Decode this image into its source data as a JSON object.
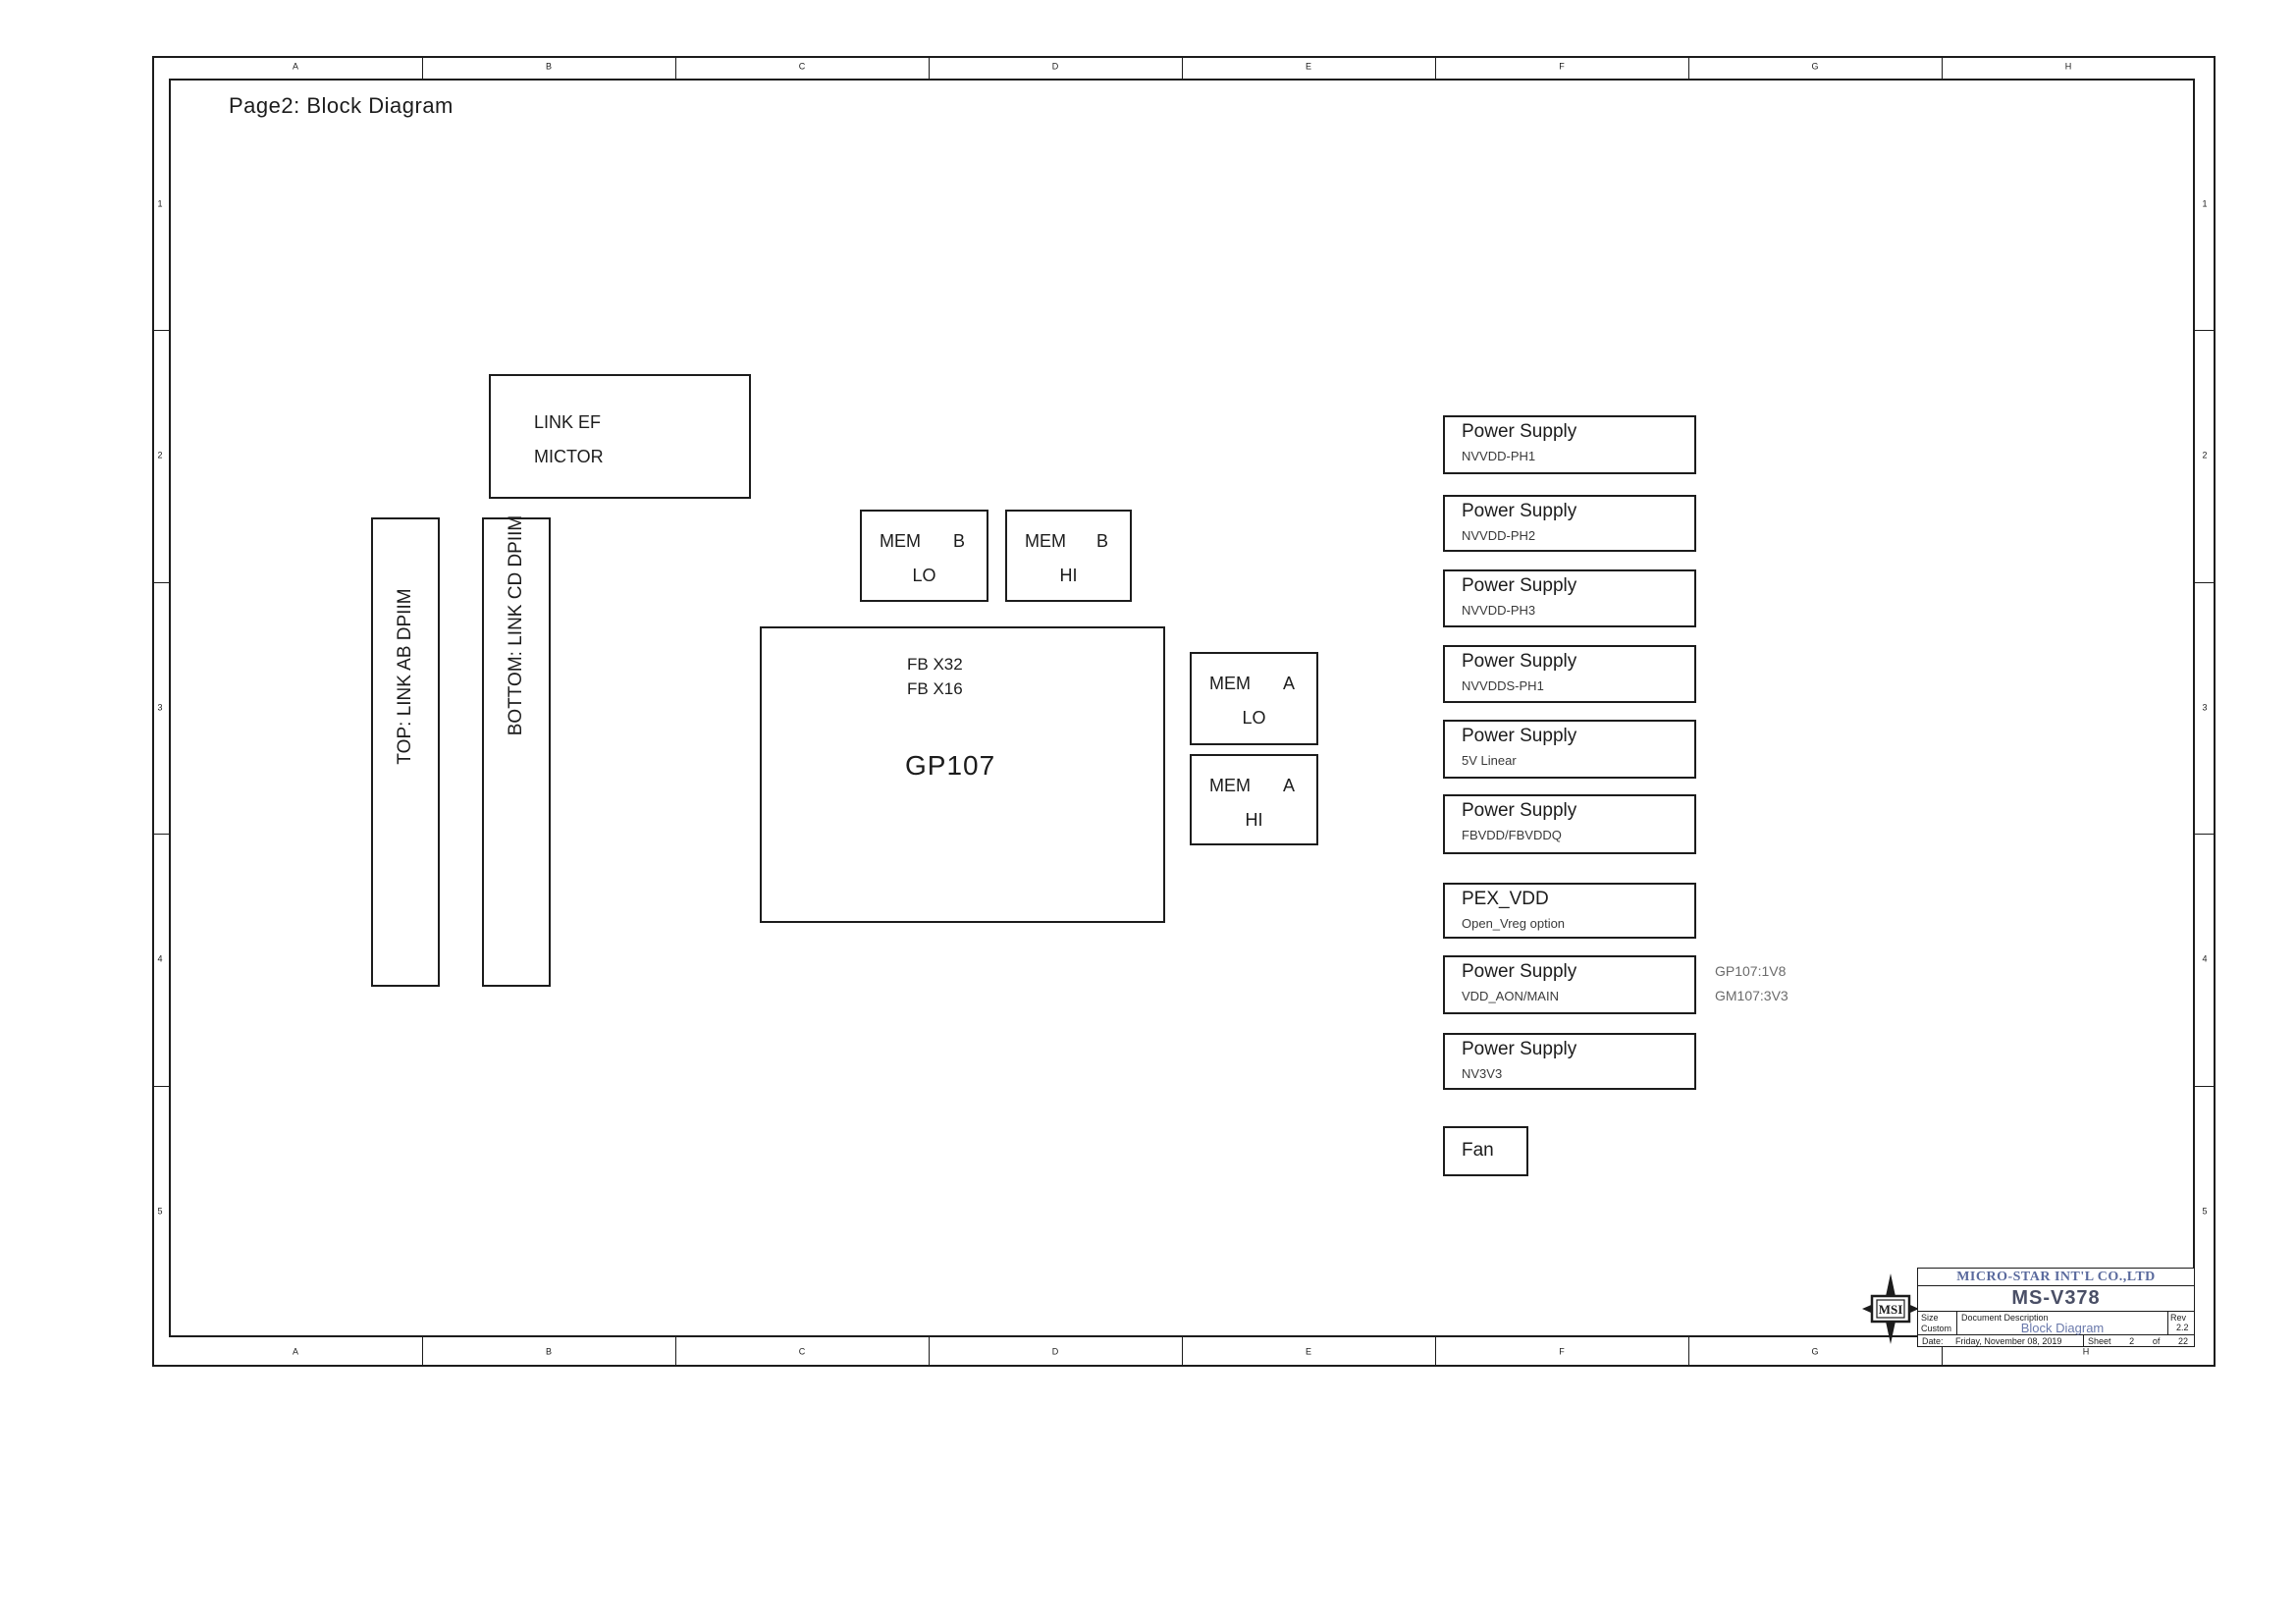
{
  "page": {
    "title": "Page2: Block Diagram"
  },
  "frame": {
    "col_labels": [
      "A",
      "B",
      "C",
      "D",
      "E",
      "F",
      "G",
      "H"
    ],
    "row_labels": [
      "1",
      "2",
      "3",
      "4",
      "5"
    ]
  },
  "blocks": {
    "mictor": {
      "line1": "LINK EF",
      "line2": "MICTOR"
    },
    "dpiim_ab": {
      "label": "TOP: LINK AB DPIIM"
    },
    "dpiim_cd": {
      "label": "BOTTOM: LINK CD DPIIM"
    },
    "mem_boxes": [
      {
        "group": "MEM",
        "channel": "B",
        "level": "LO"
      },
      {
        "group": "MEM",
        "channel": "B",
        "level": "HI"
      },
      {
        "group": "MEM",
        "channel": "A",
        "level": "LO"
      },
      {
        "group": "MEM",
        "channel": "A",
        "level": "HI"
      }
    ],
    "gp107": {
      "fb_lines": [
        "FB X32",
        "FB X16"
      ],
      "name": "GP107"
    },
    "power_supplies": [
      {
        "title": "Power Supply",
        "subtitle": "NVVDD-PH1"
      },
      {
        "title": "Power Supply",
        "subtitle": "NVVDD-PH2"
      },
      {
        "title": "Power Supply",
        "subtitle": "NVVDD-PH3"
      },
      {
        "title": "Power Supply",
        "subtitle": "NVVDDS-PH1"
      },
      {
        "title": "Power Supply",
        "subtitle": "5V Linear"
      },
      {
        "title": "Power Supply",
        "subtitle": "FBVDD/FBVDDQ"
      },
      {
        "title": "PEX_VDD",
        "subtitle": "Open_Vreg option"
      },
      {
        "title": "Power Supply",
        "subtitle": "VDD_AON/MAIN"
      },
      {
        "title": "Power Supply",
        "subtitle": "NV3V3"
      }
    ],
    "fan": {
      "label": "Fan"
    },
    "side_notes": [
      "GP107:1V8",
      "GM107:3V3"
    ]
  },
  "title_block": {
    "logo_text": "MSI",
    "company": "MICRO-STAR INT'L CO.,LTD",
    "model": "MS-V378",
    "size_label": "Size",
    "size_value": "Custom",
    "doc_desc_label": "Document Description",
    "doc_title": "Block Diagram",
    "rev_label": "Rev",
    "rev_value": "2.2",
    "date_label": "Date:",
    "date_value": "Friday, November 08, 2019",
    "sheet_label": "Sheet",
    "sheet_number": "2",
    "of_label": "of",
    "sheet_total": "22"
  },
  "colors": {
    "line": "#1c1c1c",
    "blue_text": "#5a6a9d",
    "model_text": "#4a4f66"
  }
}
